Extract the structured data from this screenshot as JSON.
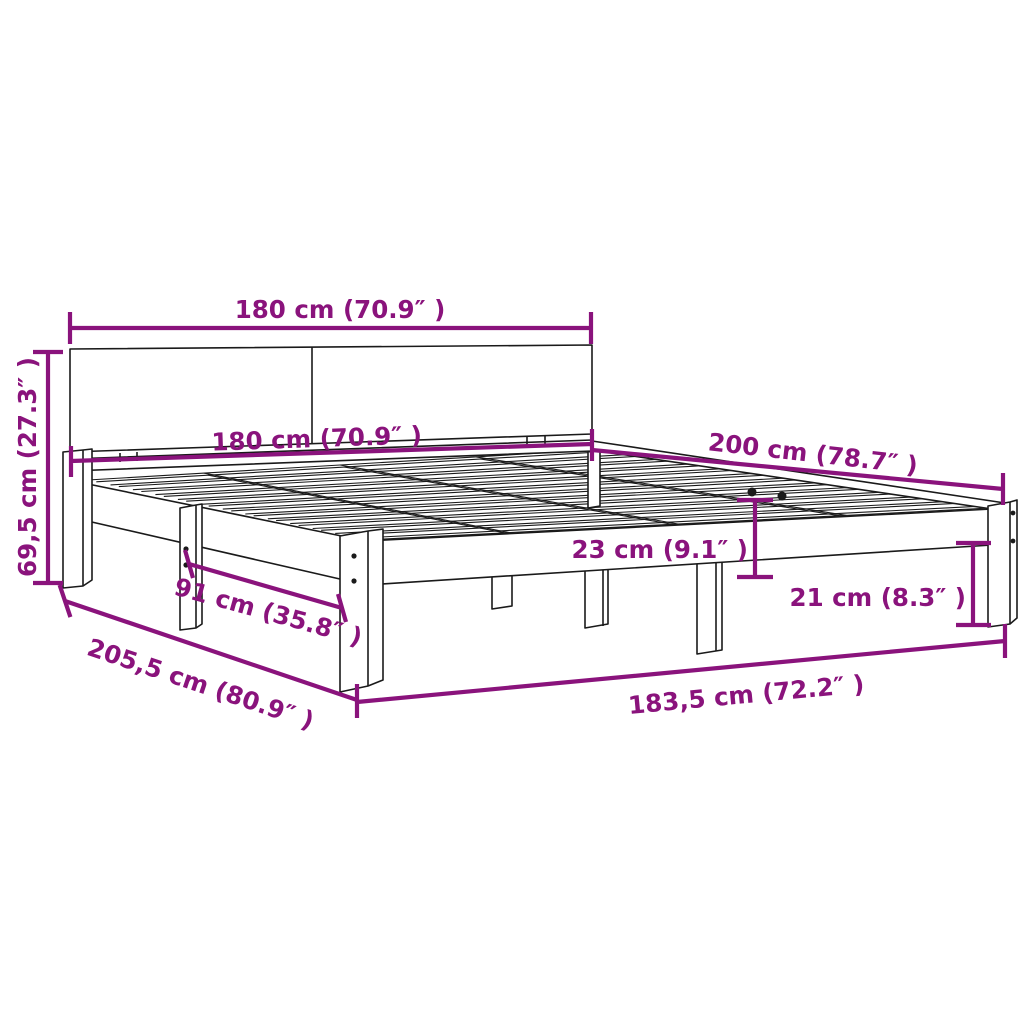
{
  "diagram": {
    "type": "bed frame dimension drawing",
    "colors": {
      "dimension_annotations": "#8A137C",
      "outline": "#1A1A1A",
      "background": "#FFFFFF"
    },
    "dimensions": [
      {
        "name": "headboard width",
        "label": "180 cm (70.9″ )"
      },
      {
        "name": "platform width",
        "label": "180 cm (70.9″ )"
      },
      {
        "name": "bed length",
        "label": "200 cm (78.7″ )"
      },
      {
        "name": "headboard height",
        "label": "69,5 cm (27.3″ )"
      },
      {
        "name": "frame height",
        "label": "23 cm (9.1″ )"
      },
      {
        "name": "leg height",
        "label": "21 cm (8.3″ )"
      },
      {
        "name": "leg spacing",
        "label": "91 cm (35.8″ )"
      },
      {
        "name": "total length",
        "label": "205,5 cm (80.9″ )"
      },
      {
        "name": "total width",
        "label": "183,5 cm (72.2″ )"
      }
    ]
  }
}
